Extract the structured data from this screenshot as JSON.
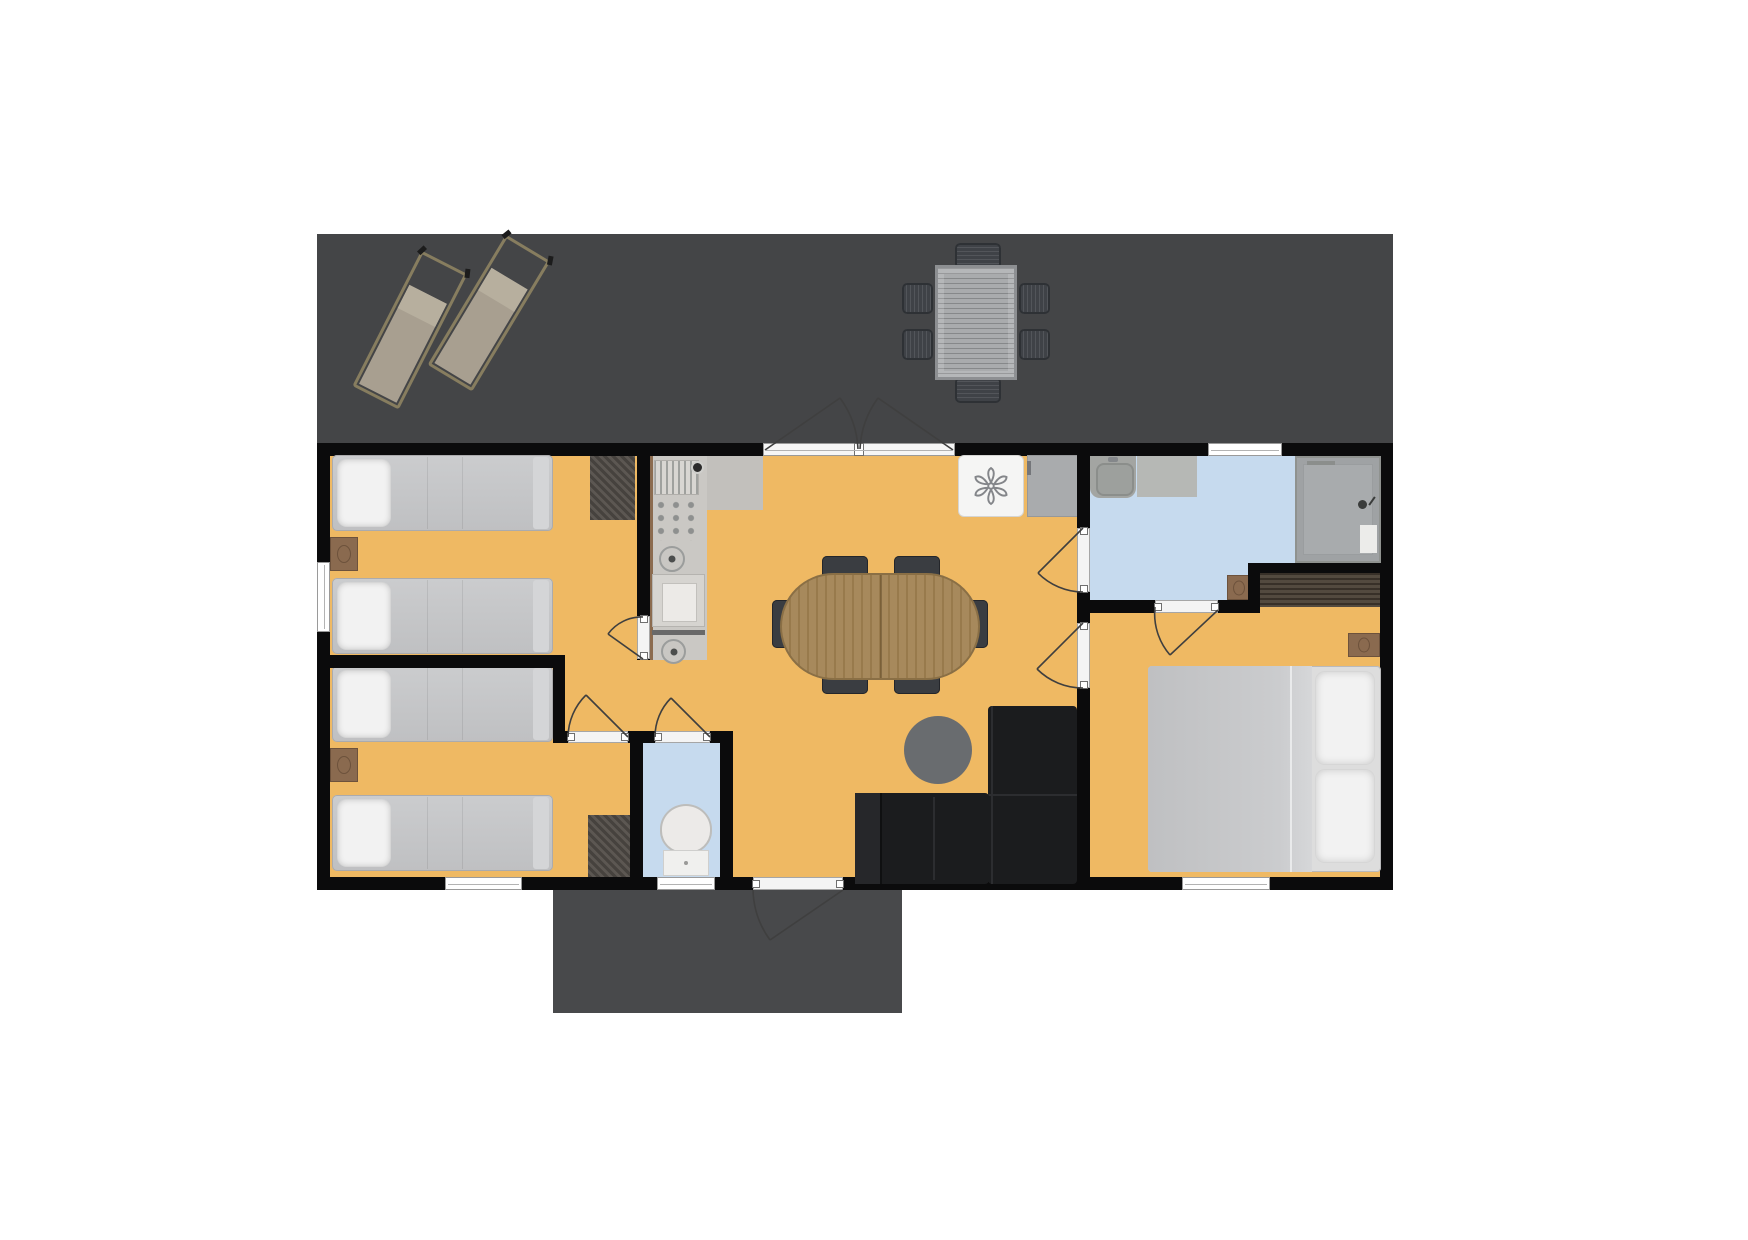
{
  "scene": {
    "kind": "holiday-home-floor-plan",
    "text_labels": []
  },
  "colors": {
    "floor": "#efb963",
    "wet_floor": "#c6daee",
    "wall": "#0b0b0c",
    "deck": "#444547",
    "deck_lower": "#48494b",
    "counter": "#cac8c4",
    "bed": "#c5c6c8",
    "pillow": "#f2f2f2",
    "sofa": "#1b1c1e",
    "wood_table": "#a28353",
    "chair": "#3a3d41",
    "wardrobe": "#4a4035",
    "nightstand": "#8a6a4f",
    "rug_dark": "#55504b",
    "shower": "#a8abad",
    "fixture_white": "#f0f0ee",
    "outdoor_table": "#a4a6a8",
    "outdoor_chair": "#3f4247",
    "lounger_frame": "#877d5f",
    "lounger_cushion": "#a89f90",
    "arc": "#3f3f3f",
    "window": "#ffffff"
  },
  "areas": [
    {
      "name": "terrace-top",
      "furniture": [
        "sun-lounger",
        "sun-lounger",
        "outdoor-dining-table",
        "outdoor-chair",
        "outdoor-chair",
        "outdoor-chair",
        "outdoor-chair",
        "outdoor-chair",
        "outdoor-chair"
      ]
    },
    {
      "name": "entrance-deck",
      "furniture": []
    },
    {
      "name": "bedroom-1",
      "furniture": [
        "single-bed",
        "single-bed",
        "nightstand",
        "dark-rug"
      ]
    },
    {
      "name": "bedroom-2",
      "furniture": [
        "single-bed",
        "single-bed",
        "nightstand",
        "dark-rug"
      ]
    },
    {
      "name": "living-kitchen",
      "furniture": [
        "kitchen-counter",
        "dish-rack",
        "hob-knobs",
        "burner",
        "oven",
        "burner",
        "heater-fan-unit",
        "tall-cabinet",
        "oval-dining-table",
        "dining-chair",
        "dining-chair",
        "dining-chair",
        "dining-chair",
        "dining-chair",
        "dining-chair",
        "round-side-table",
        "corner-sofa"
      ]
    },
    {
      "name": "bathroom",
      "furniture": [
        "washbasin",
        "vanity-counter",
        "walk-in-shower",
        "bath-mat"
      ]
    },
    {
      "name": "toilet-room",
      "furniture": [
        "toilet"
      ]
    },
    {
      "name": "master-bedroom",
      "furniture": [
        "double-bed",
        "wardrobe",
        "nightstand"
      ]
    }
  ],
  "openings": {
    "windows": 5,
    "interior_doors": 6,
    "exterior_doors": 2,
    "french_door_leaves": 2
  }
}
